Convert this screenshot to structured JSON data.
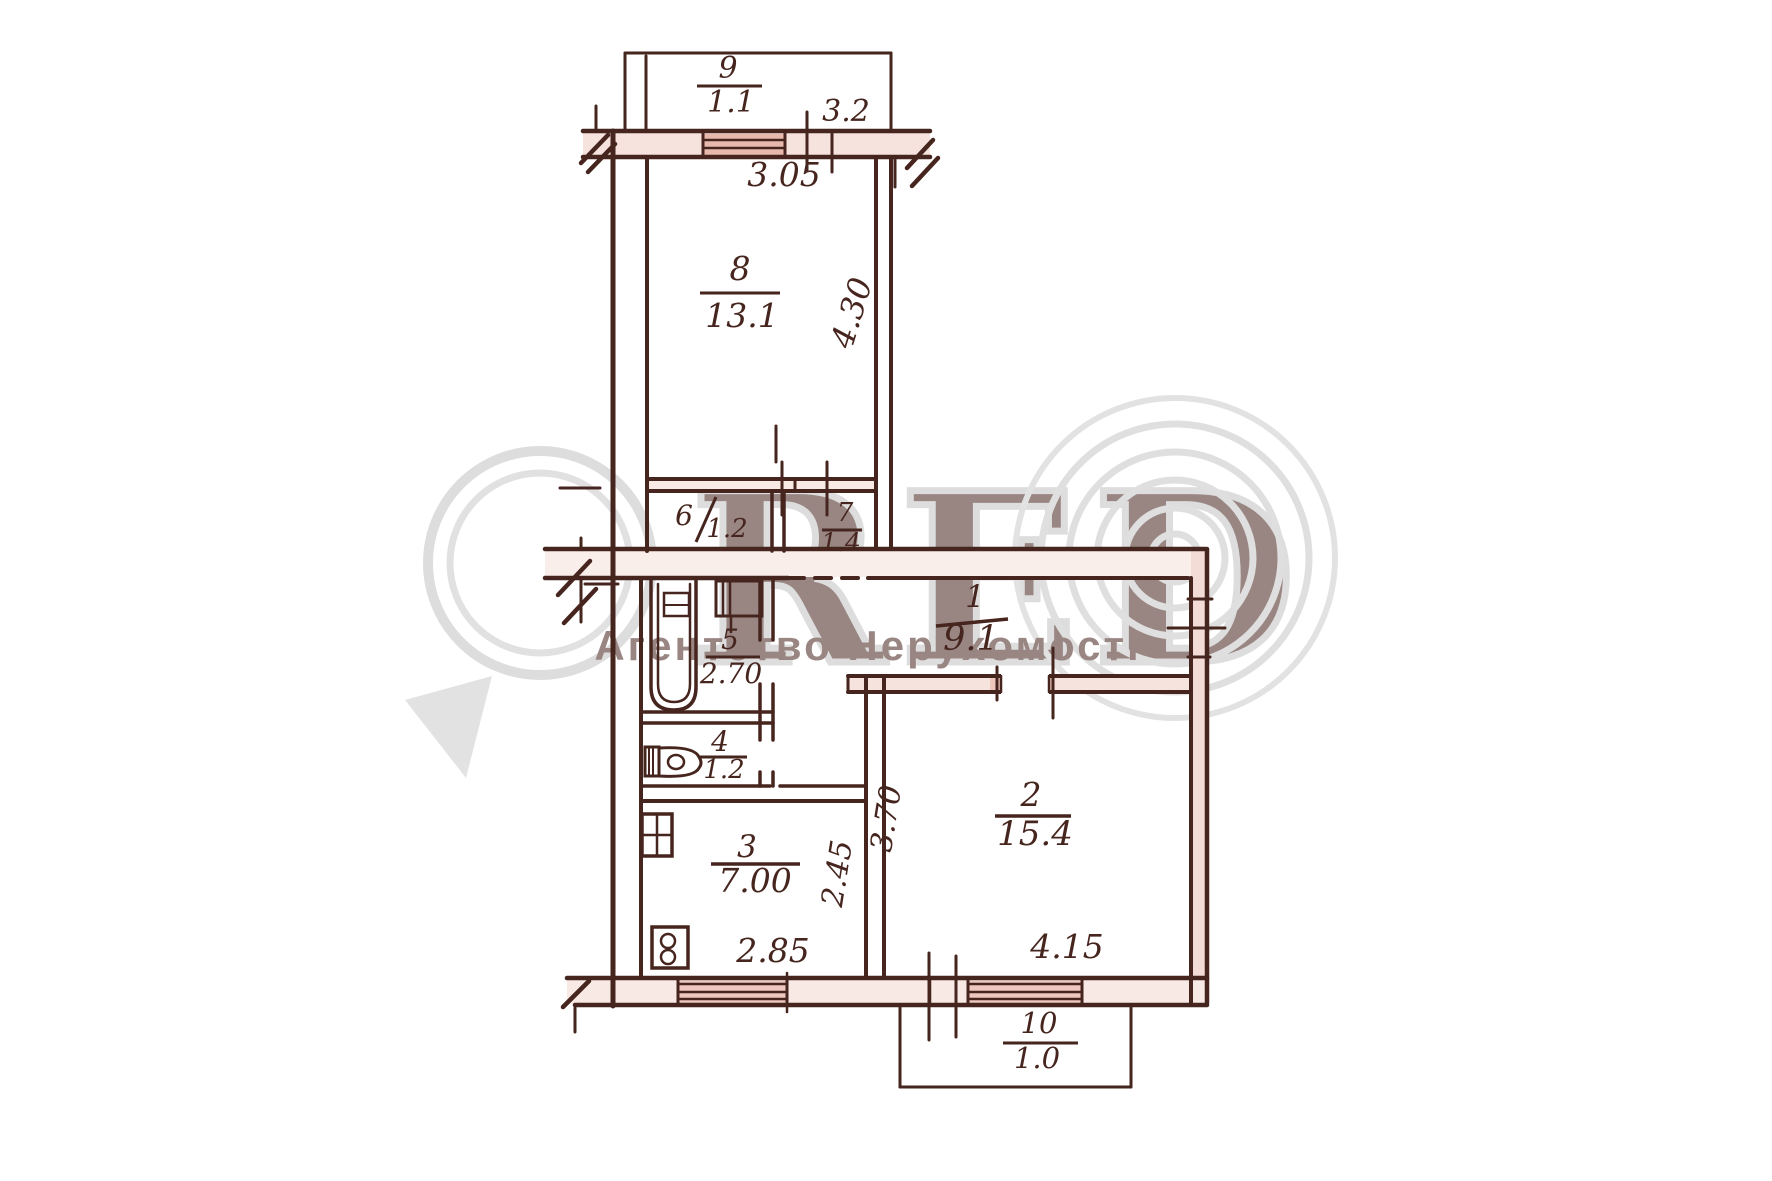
{
  "plan": {
    "watermark": {
      "brand": "RED",
      "agency": "Агентство Нерухомості"
    },
    "rooms": {
      "r1": {
        "number": "1",
        "area": "9.1"
      },
      "r2": {
        "number": "2",
        "area": "15.4"
      },
      "r3": {
        "number": "3",
        "area": "7.00"
      },
      "r4": {
        "number": "4",
        "area": "1.2"
      },
      "r5": {
        "number": "5",
        "area": "2.70"
      },
      "r6": {
        "number": "6",
        "area": "1.2"
      },
      "r7": {
        "number": "7",
        "area": "1.4"
      },
      "r8": {
        "number": "8",
        "area": "13.1"
      },
      "r9": {
        "number": "9",
        "area": "1.1"
      },
      "r10": {
        "number": "10",
        "area": "1.0"
      }
    },
    "dimensions": {
      "balcony_top_width": "3.2",
      "room8_width": "3.05",
      "room8_depth": "4.30",
      "room2_depth": "3.70",
      "room2_width": "4.15",
      "kitchen_depth": "2.45",
      "kitchen_width": "2.85"
    }
  }
}
